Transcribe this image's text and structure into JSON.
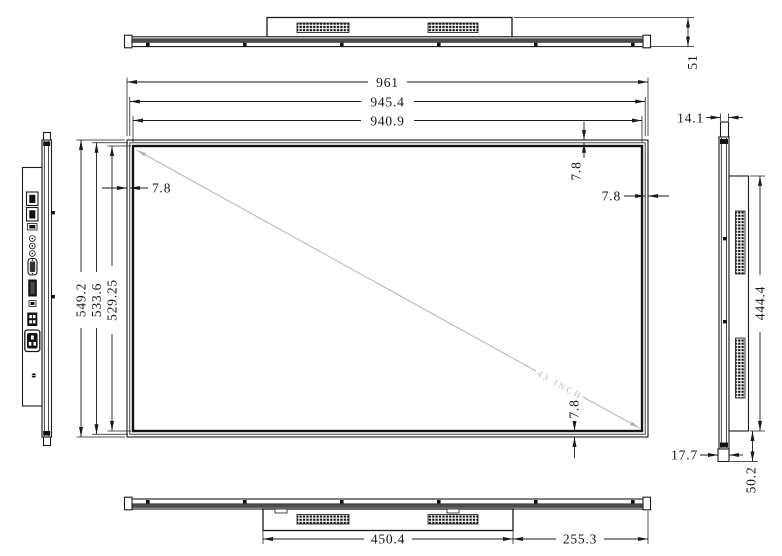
{
  "drawing": {
    "views": {
      "top": {
        "depth": "51"
      },
      "front": {
        "width_outer": "961",
        "width_mid": "945.4",
        "width_active": "940.9",
        "height_outer": "549.2",
        "height_mid": "533.6",
        "height_active": "529.25",
        "bezel_left": "7.8",
        "bezel_top": "7.8",
        "bezel_right": "7.8",
        "bezel_bottom": "7.8",
        "diagonal_label": "43 INCH"
      },
      "right": {
        "top_thickness": "14.1",
        "box_height": "444.4",
        "bottom_depth": "50.2",
        "bottom_thickness": "17.7"
      },
      "bottom": {
        "box_width": "450.4",
        "right_offset": "255.3"
      }
    },
    "colors": {
      "line": "#1a1a1a",
      "band": "#4d4d4d",
      "diagonal": "#b5b5b5"
    }
  }
}
